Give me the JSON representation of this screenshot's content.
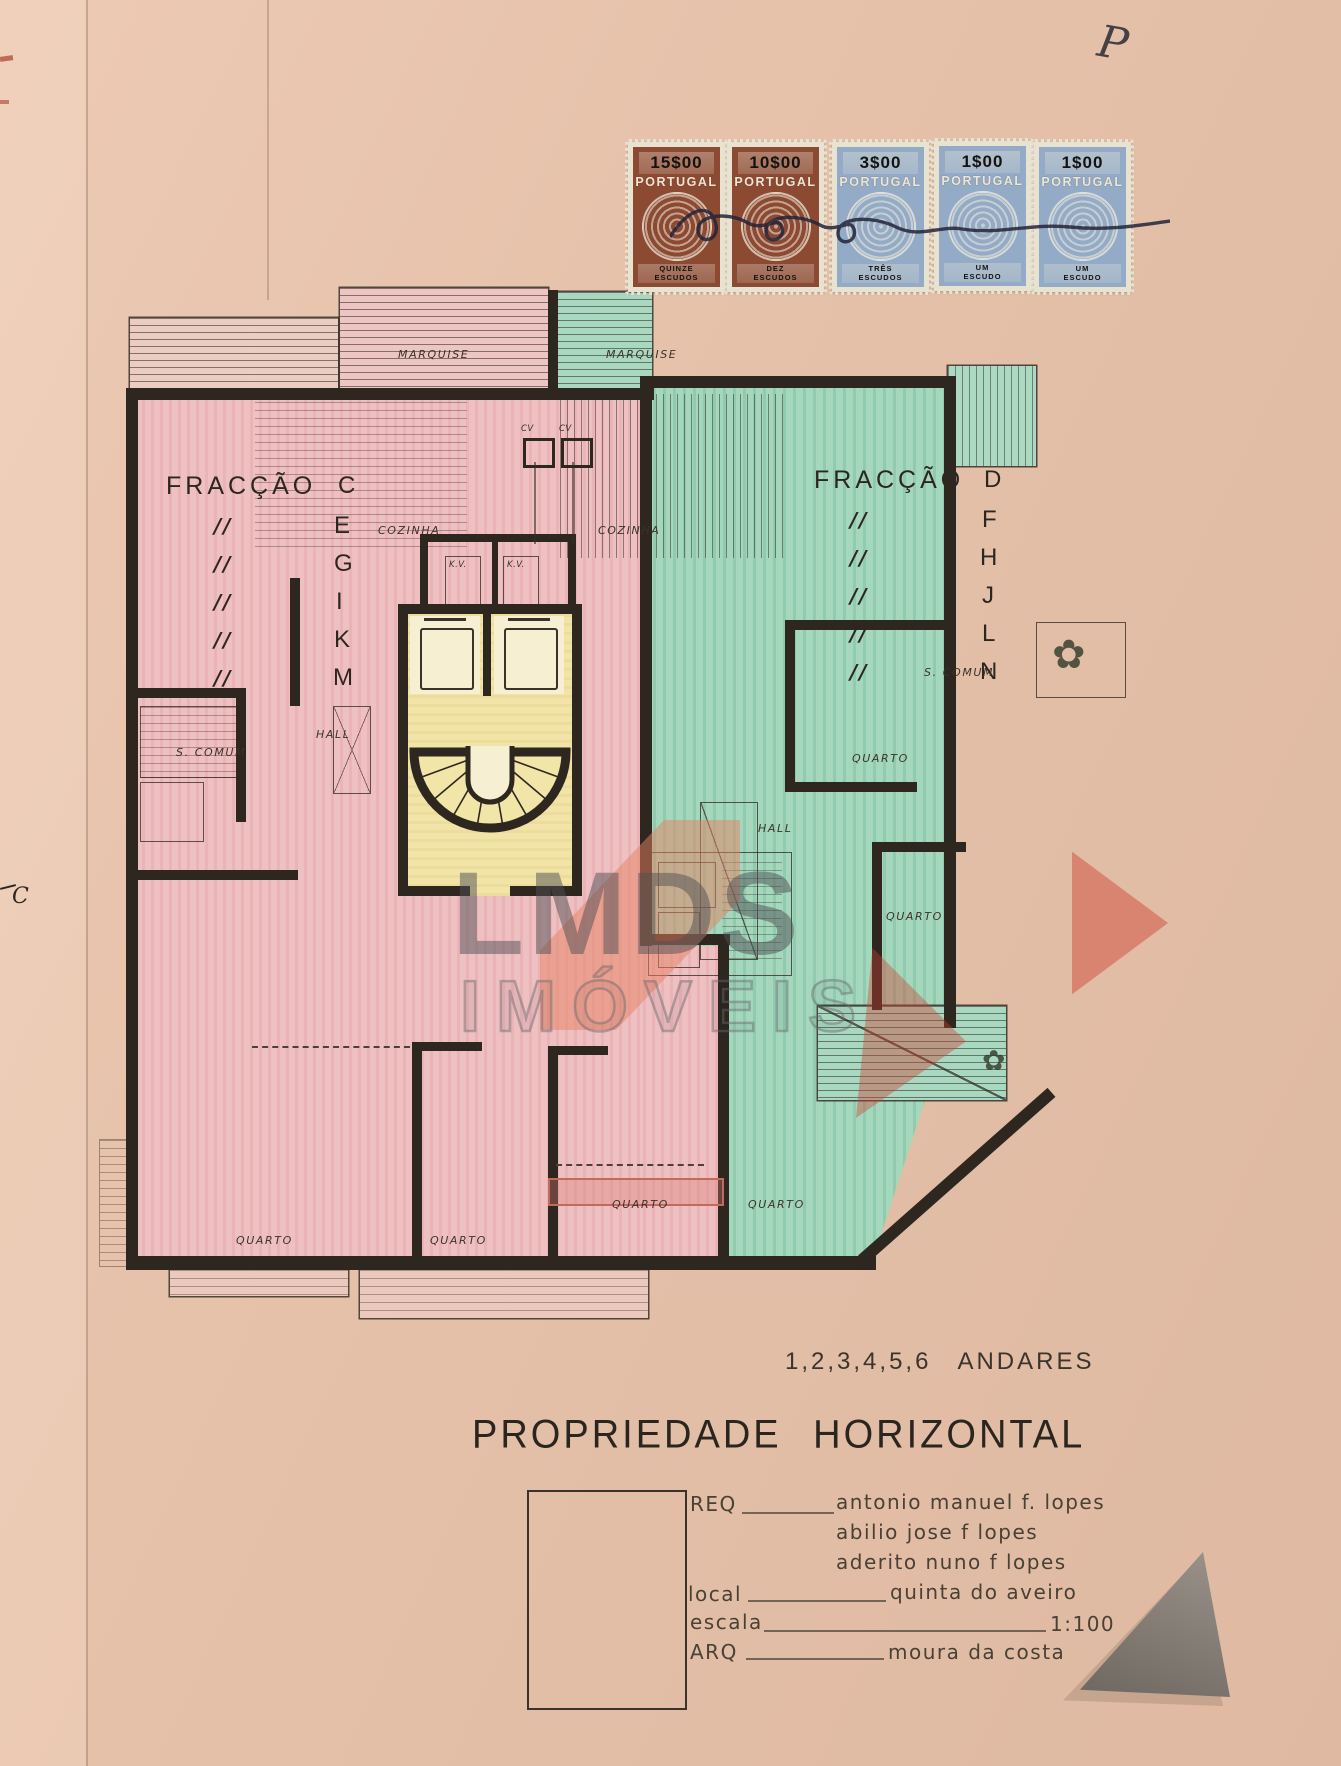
{
  "page": {
    "corner_mark": "P",
    "margin_mark": "C"
  },
  "stamps": {
    "country": "PORTUGAL",
    "items": [
      {
        "value": "15$00",
        "denom1": "QUINZE",
        "denom2": "ESCUDOS",
        "palette": "#8d4a33"
      },
      {
        "value": "10$00",
        "denom1": "DEZ",
        "denom2": "ESCUDOS",
        "palette": "#8d4a33"
      },
      {
        "value": "3$00",
        "denom1": "TRÊS",
        "denom2": "ESCUDOS",
        "palette": "#93abc6"
      },
      {
        "value": "1$00",
        "denom1": "UM",
        "denom2": "ESCUDO",
        "palette": "#93abc6"
      },
      {
        "value": "1$00",
        "denom1": "UM",
        "denom2": "ESCUDO",
        "palette": "#93abc6"
      }
    ]
  },
  "plan": {
    "fractions": {
      "ditto": "//",
      "left": {
        "title": "FRACÇÃO",
        "letters": [
          "C",
          "E",
          "G",
          "I",
          "K",
          "M"
        ]
      },
      "right": {
        "title": "FRACÇÃO",
        "letters": [
          "D",
          "F",
          "H",
          "J",
          "L",
          "N"
        ]
      }
    },
    "labels": {
      "marquise": "MARQUISE",
      "cozinha": "COZINHA",
      "hall": "HALL",
      "s_comum": "S. COMUM",
      "quarto": "QUARTO",
      "cv": "CV",
      "kv": "K.V."
    },
    "colors": {
      "left_fill": "#efc0c2",
      "right_fill": "#a5d7bd",
      "core_fill": "#f1e4a6",
      "wall": "#2d2720"
    }
  },
  "watermark": {
    "line1": "LMDS",
    "line2": "IMÓVEIS"
  },
  "footer": {
    "floors_numbers": "1,2,3,4,5,6",
    "floors_word": "ANDARES",
    "title": "PROPRIEDADE HORIZONTAL",
    "req_label": "REQ",
    "req_values": [
      "antonio manuel f. lopes",
      "abilio jose f lopes",
      "aderito nuno f lopes"
    ],
    "local_label": "local",
    "local_value": "quinta do aveiro",
    "escala_label": "escala",
    "escala_value": "1:100",
    "arq_label": "ARQ",
    "arq_value": "moura da costa"
  }
}
